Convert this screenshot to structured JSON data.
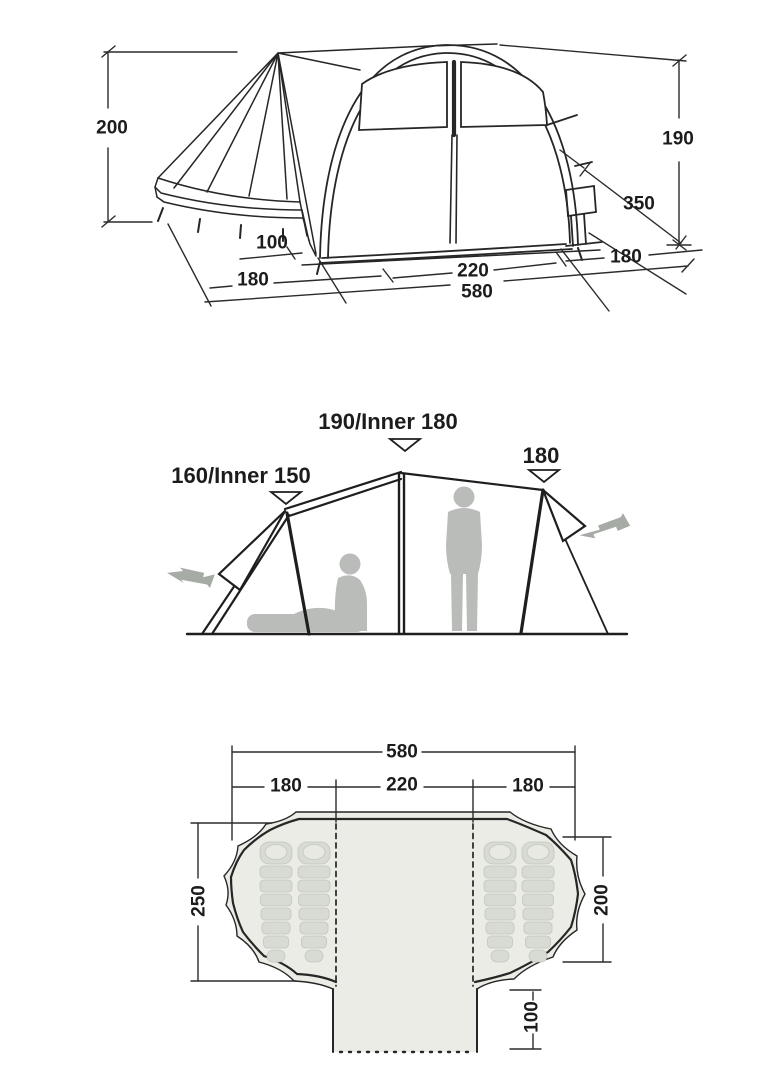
{
  "title": "Tent dimensions technical diagram",
  "colors": {
    "line": "#262626",
    "dim_line": "#2b2b2b",
    "floor_fill": "#eaece5",
    "bag_fill": "#d8dbd3",
    "bag_detail": "#e7e9e2",
    "silhouette": "#b9bcb8",
    "arrow": "#a7aba6"
  },
  "icons": [
    "marker-triangle-icon",
    "double-arrow-icon",
    "sleeping-bag-icon",
    "person-standing-icon",
    "person-sitting-icon"
  ],
  "side_view": {
    "height_left": "200",
    "height_right": "190",
    "side_depth": "350",
    "porch_offset": "100",
    "left_section": "180",
    "center_section": "220",
    "right_section": "180",
    "total_length": "580"
  },
  "cross_section": {
    "left_peak": "160/Inner 150",
    "center_peak": "190/Inner 180",
    "right_peak": "180"
  },
  "floor_plan": {
    "total_length": "580",
    "left_section": "180",
    "center_section": "220",
    "right_section": "180",
    "left_depth": "250",
    "right_depth": "200",
    "porch_depth": "100"
  }
}
